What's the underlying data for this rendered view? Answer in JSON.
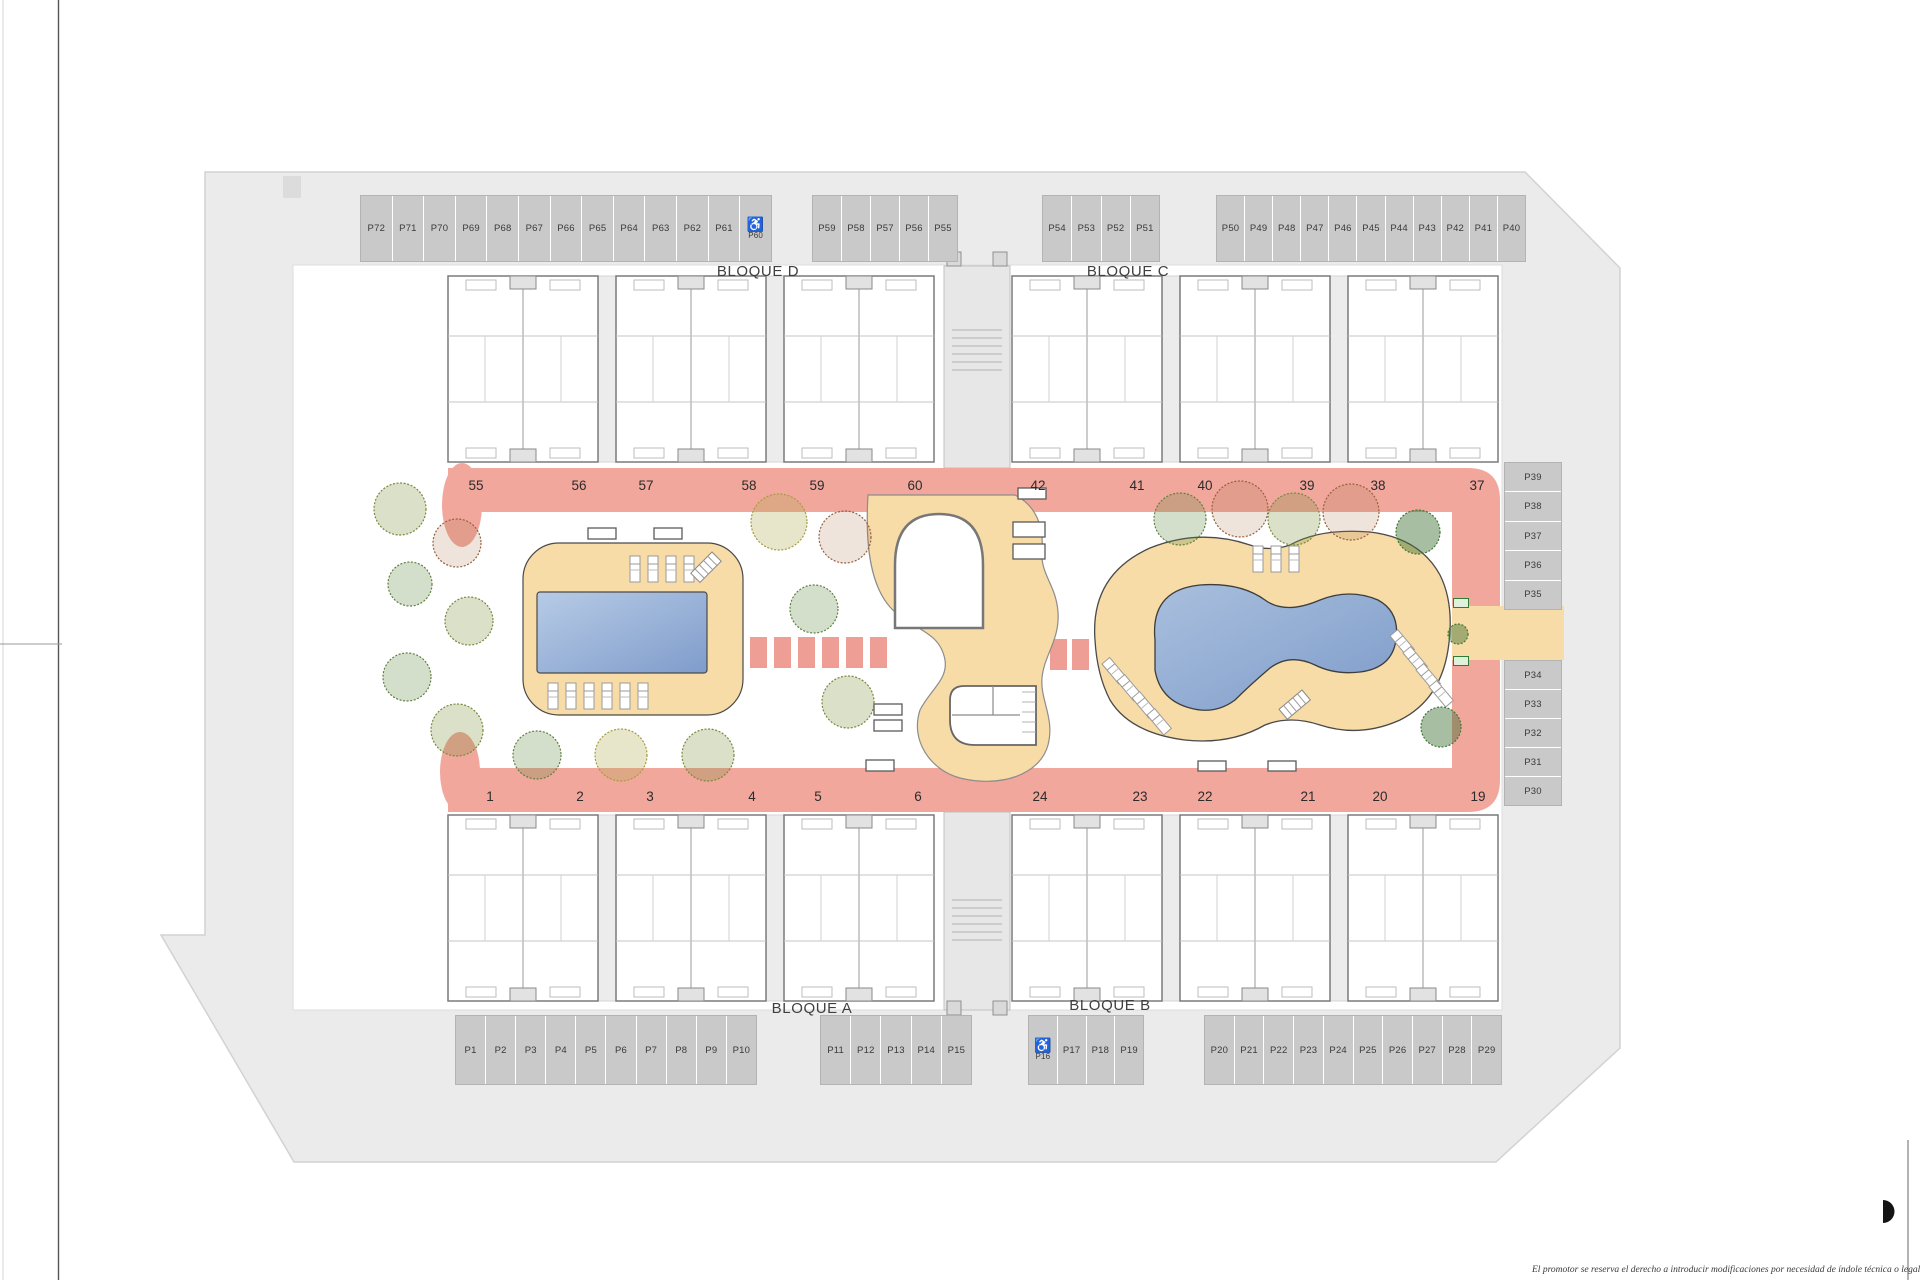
{
  "site": {
    "disclaimer": "El promotor se reserva el derecho a introducir modificaciones por necesidad de índole técnica o legal",
    "blocks": {
      "a": "BLOQUE A",
      "b": "BLOQUE B",
      "c": "BLOQUE C",
      "d": "BLOQUE D"
    }
  },
  "parking": {
    "top_left": [
      "P72",
      "P71",
      "P70",
      "P69",
      "P68",
      "P67",
      "P66",
      "P65",
      "P64",
      "P63",
      "P62",
      "P61"
    ],
    "top_left_disabled": "P60",
    "top_center": [
      "P59",
      "P58",
      "P57",
      "P56",
      "P55"
    ],
    "top_center2": [
      "P54",
      "P53",
      "P52",
      "P51"
    ],
    "top_right": [
      "P50",
      "P49",
      "P48",
      "P47",
      "P46",
      "P45",
      "P44",
      "P43",
      "P42",
      "P41",
      "P40"
    ],
    "right_upper": [
      "P39",
      "P38",
      "P37",
      "P36",
      "P35"
    ],
    "right_lower": [
      "P34",
      "P33",
      "P32",
      "P31",
      "P30"
    ],
    "bottom_left": [
      "P1",
      "P2",
      "P3",
      "P4",
      "P5",
      "P6",
      "P7",
      "P8",
      "P9",
      "P10"
    ],
    "bottom_center": [
      "P11",
      "P12",
      "P13",
      "P14",
      "P15"
    ],
    "bottom_disabled": "P16",
    "bottom_center2": [
      "P17",
      "P18",
      "P19"
    ],
    "bottom_right": [
      "P20",
      "P21",
      "P22",
      "P23",
      "P24",
      "P25",
      "P26",
      "P27",
      "P28",
      "P29"
    ]
  },
  "units": {
    "top": [
      "55",
      "56",
      "57",
      "58",
      "59",
      "60",
      "42",
      "41",
      "40",
      "39",
      "38",
      "37"
    ],
    "bottom": [
      "1",
      "2",
      "3",
      "4",
      "5",
      "6",
      "24",
      "23",
      "22",
      "21",
      "20",
      "19"
    ]
  },
  "icons": {
    "wheelchair": "♿"
  },
  "colors": {
    "walkway": "#f2a79d",
    "deck": "#f7dca8",
    "pool_dark": "#7f9ccb",
    "pool_light": "#b7cbe6",
    "road": "#ebebeb",
    "stall": "#c9c9c9"
  }
}
